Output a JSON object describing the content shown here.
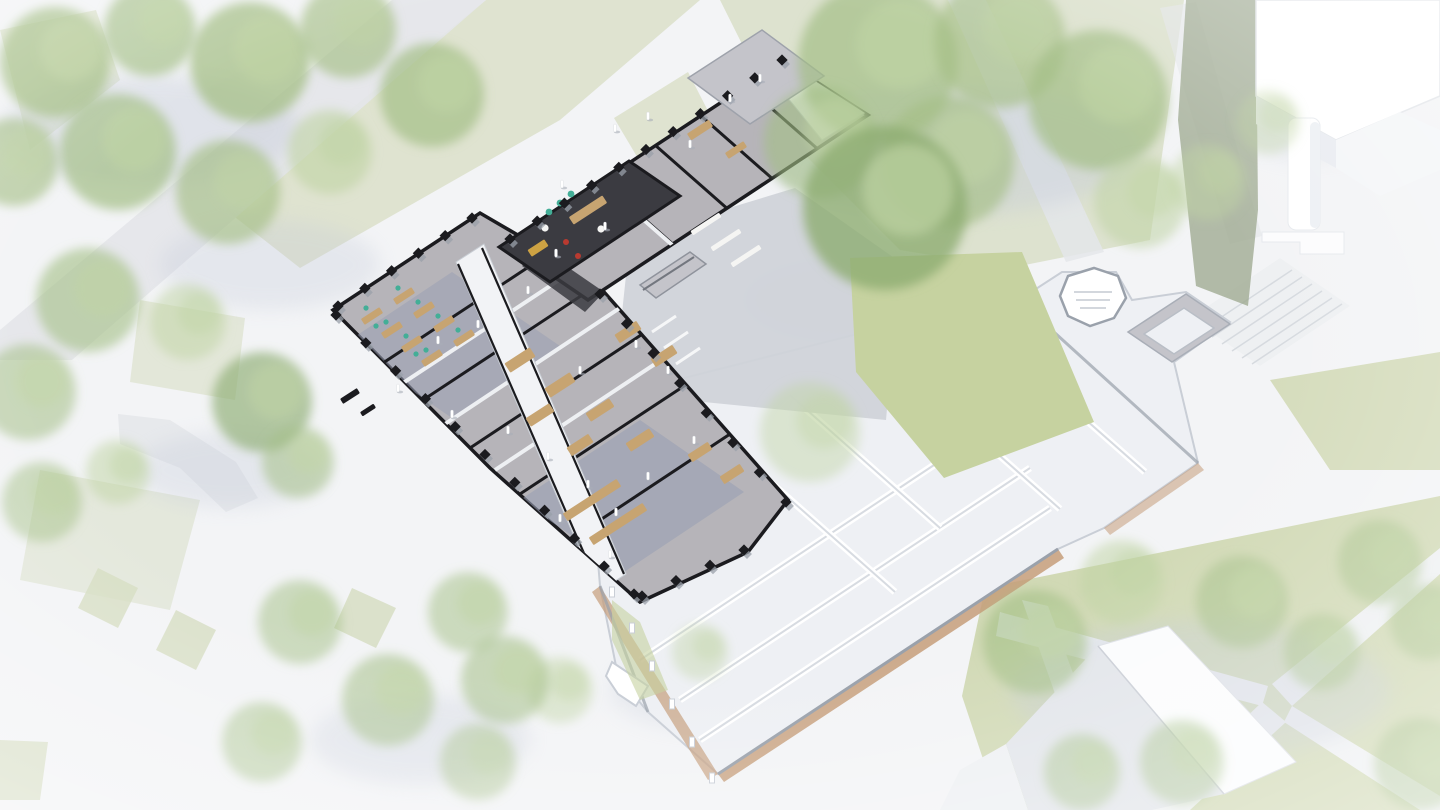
{
  "meta": {
    "description": "Aerial axonometric cutaway rendering of an L-shaped collegiate Gothic building. The north-west wing is shown in detail with black sectioned walls, pinnacled buttresses, grey floors and coloured furniture; the remainder of the quad is ghosted white. Washed-out park landscape with lawns, paths and trees surrounds it; white massing blocks sit top-right and bottom."
  },
  "colors": {
    "bg": "#f3f4f6",
    "path": "#e4e6ea",
    "pathBright": "#eef0f2",
    "grassPale": "#d5dcc1",
    "grassCourt": "#c6d2a0",
    "grassRight": "#cdd6ae",
    "treeGreen": "#a4bf86",
    "treeLight": "#c0d4a4",
    "treeDark": "#8dac72",
    "olive": "#9ba78c",
    "shadow": "#c5cbd9",
    "ghostWall": "#fcfdfe",
    "ghostStroke": "#c9ced6",
    "ghostFloor": "#eef0f4",
    "ghostCap": "#9aa1ab",
    "brick": "#c59d7a",
    "darkWall": "#1b1b1f",
    "floorGray": "#b6b4b9",
    "floorBlue": "#9aa0b4",
    "floorOffice": "#a9acb8",
    "roofGray": "#c4c4ca",
    "corridor": "#f2f3f6",
    "wood": "#c7a471",
    "teal": "#43ae97",
    "red": "#b93a30",
    "yellow": "#cda243",
    "darkFloor": "#3b3b41",
    "white": "#f5f5f3",
    "stepGray": "#d0d3d9",
    "people": "#ffffff"
  },
  "scene": {
    "trees": [
      [
        55,
        62,
        55,
        "g",
        0.75
      ],
      [
        150,
        30,
        46,
        "g",
        0.7
      ],
      [
        250,
        62,
        60,
        "g",
        0.75
      ],
      [
        348,
        30,
        48,
        "g",
        0.65
      ],
      [
        432,
        95,
        52,
        "g",
        0.7
      ],
      [
        118,
        152,
        58,
        "g",
        0.7
      ],
      [
        14,
        162,
        44,
        "g",
        0.65
      ],
      [
        228,
        192,
        52,
        "g",
        0.65
      ],
      [
        330,
        152,
        42,
        "l",
        0.6
      ],
      [
        88,
        300,
        52,
        "g",
        0.6
      ],
      [
        28,
        392,
        48,
        "g",
        0.55
      ],
      [
        188,
        322,
        38,
        "l",
        0.5
      ],
      [
        262,
        402,
        50,
        "d",
        0.65
      ],
      [
        298,
        462,
        36,
        "g",
        0.55
      ],
      [
        118,
        472,
        32,
        "l",
        0.5
      ],
      [
        42,
        502,
        40,
        "g",
        0.5
      ],
      [
        300,
        622,
        42,
        "g",
        0.5
      ],
      [
        388,
        700,
        46,
        "g",
        0.55
      ],
      [
        262,
        742,
        40,
        "g",
        0.5
      ],
      [
        478,
        762,
        38,
        "g",
        0.45
      ],
      [
        878,
        62,
        80,
        "g",
        0.7
      ],
      [
        1000,
        42,
        66,
        "g",
        0.65
      ],
      [
        1098,
        100,
        70,
        "g",
        0.7
      ],
      [
        948,
        162,
        66,
        "g",
        0.65
      ],
      [
        820,
        142,
        56,
        "g",
        0.6
      ],
      [
        1140,
        202,
        46,
        "l",
        0.55
      ],
      [
        885,
        208,
        82,
        "d",
        0.8
      ],
      [
        810,
        432,
        50,
        "l",
        0.45
      ],
      [
        1208,
        182,
        38,
        "l",
        0.45
      ],
      [
        1268,
        122,
        32,
        "l",
        0.4
      ],
      [
        1035,
        642,
        52,
        "g",
        0.6
      ],
      [
        1122,
        582,
        42,
        "l",
        0.5
      ],
      [
        1242,
        602,
        46,
        "g",
        0.55
      ],
      [
        1380,
        562,
        42,
        "g",
        0.5
      ],
      [
        1322,
        652,
        38,
        "g",
        0.5
      ],
      [
        1428,
        622,
        38,
        "g",
        0.5
      ],
      [
        1182,
        762,
        42,
        "g",
        0.5
      ],
      [
        1420,
        764,
        46,
        "g",
        0.55
      ],
      [
        1082,
        772,
        38,
        "g",
        0.5
      ],
      [
        560,
        690,
        33,
        "l",
        0.45
      ],
      [
        700,
        652,
        28,
        "l",
        0.4
      ],
      [
        468,
        612,
        40,
        "g",
        0.5
      ],
      [
        505,
        680,
        44,
        "g",
        0.55
      ]
    ],
    "tree_shadows": [
      [
        150,
        130,
        150,
        55,
        0.4
      ],
      [
        270,
        265,
        110,
        45,
        0.3
      ],
      [
        950,
        150,
        190,
        65,
        0.4
      ],
      [
        860,
        300,
        115,
        42,
        0.35
      ],
      [
        1200,
        690,
        190,
        70,
        0.35
      ],
      [
        230,
        470,
        95,
        38,
        0.3
      ],
      [
        420,
        740,
        110,
        45,
        0.3
      ],
      [
        1310,
        120,
        80,
        40,
        0.25
      ],
      [
        700,
        690,
        90,
        40,
        0.25
      ]
    ],
    "pinnacle_walls": [
      {
        "x1": 510,
        "y1": 239,
        "x2": 782,
        "y2": 60,
        "n": 11
      },
      {
        "x1": 338,
        "y1": 306,
        "x2": 472,
        "y2": 218,
        "n": 6
      },
      {
        "x1": 336,
        "y1": 315,
        "x2": 634,
        "y2": 594,
        "n": 11
      },
      {
        "x1": 600,
        "y1": 294,
        "x2": 786,
        "y2": 502,
        "n": 8
      },
      {
        "x1": 642,
        "y1": 596,
        "x2": 744,
        "y2": 550,
        "n": 4
      }
    ],
    "wall_posts": [
      [
        612,
        592
      ],
      [
        632,
        628
      ],
      [
        652,
        666
      ],
      [
        672,
        704
      ],
      [
        692,
        742
      ],
      [
        712,
        778
      ]
    ],
    "furniture": [
      [
        372,
        316,
        22,
        7,
        -33,
        "wood"
      ],
      [
        392,
        330,
        22,
        7,
        -33,
        "wood"
      ],
      [
        412,
        344,
        22,
        7,
        -33,
        "wood"
      ],
      [
        432,
        358,
        22,
        7,
        -33,
        "wood"
      ],
      [
        404,
        296,
        22,
        7,
        -33,
        "wood"
      ],
      [
        424,
        310,
        22,
        7,
        -33,
        "wood"
      ],
      [
        444,
        324,
        22,
        7,
        -33,
        "wood"
      ],
      [
        464,
        338,
        22,
        7,
        -33,
        "wood"
      ],
      [
        350,
        396,
        20,
        6,
        -33,
        "darkWall"
      ],
      [
        368,
        410,
        16,
        5,
        -33,
        "darkWall"
      ],
      [
        520,
        360,
        30,
        11,
        -33,
        "wood"
      ],
      [
        560,
        385,
        30,
        11,
        -33,
        "wood"
      ],
      [
        540,
        415,
        28,
        10,
        -33,
        "wood"
      ],
      [
        600,
        410,
        28,
        10,
        -33,
        "wood"
      ],
      [
        640,
        440,
        28,
        10,
        -33,
        "wood"
      ],
      [
        580,
        445,
        26,
        10,
        -33,
        "wood"
      ],
      [
        628,
        332,
        26,
        10,
        -33,
        "wood"
      ],
      [
        664,
        356,
        26,
        10,
        -33,
        "wood"
      ],
      [
        700,
        452,
        24,
        9,
        -33,
        "wood"
      ],
      [
        732,
        474,
        24,
        9,
        -33,
        "wood"
      ],
      [
        592,
        500,
        64,
        9,
        -33,
        "wood"
      ],
      [
        618,
        524,
        64,
        9,
        -33,
        "wood"
      ],
      [
        700,
        130,
        26,
        8,
        -33,
        "wood"
      ],
      [
        736,
        150,
        22,
        7,
        -33,
        "wood"
      ],
      [
        588,
        210,
        40,
        9,
        -33,
        "wood"
      ],
      [
        538,
        248,
        20,
        8,
        -33,
        "yellow"
      ],
      [
        706,
        224,
        34,
        5,
        -33,
        "white"
      ],
      [
        726,
        240,
        34,
        5,
        -33,
        "white"
      ],
      [
        746,
        256,
        34,
        5,
        -33,
        "white"
      ]
    ],
    "seat_dots": [
      [
        366,
        308,
        2.6,
        "teal"
      ],
      [
        386,
        322,
        2.6,
        "teal"
      ],
      [
        406,
        336,
        2.6,
        "teal"
      ],
      [
        426,
        350,
        2.6,
        "teal"
      ],
      [
        398,
        288,
        2.6,
        "teal"
      ],
      [
        418,
        302,
        2.6,
        "teal"
      ],
      [
        438,
        316,
        2.6,
        "teal"
      ],
      [
        458,
        330,
        2.6,
        "teal"
      ],
      [
        376,
        326,
        2.6,
        "teal"
      ],
      [
        416,
        354,
        2.6,
        "teal"
      ],
      [
        549,
        212,
        3.4,
        "teal"
      ],
      [
        560,
        203,
        3.4,
        "teal"
      ],
      [
        571,
        194,
        3.4,
        "teal"
      ],
      [
        566,
        242,
        3,
        "red"
      ],
      [
        578,
        256,
        3,
        "red"
      ],
      [
        545,
        228,
        3.6,
        "white"
      ],
      [
        601,
        229,
        3.6,
        "white"
      ]
    ],
    "people": [
      [
        615,
        130
      ],
      [
        648,
        118
      ],
      [
        690,
        146
      ],
      [
        730,
        100
      ],
      [
        760,
        80
      ],
      [
        562,
        186
      ],
      [
        605,
        228
      ],
      [
        556,
        255
      ],
      [
        528,
        292
      ],
      [
        478,
        326
      ],
      [
        438,
        342
      ],
      [
        398,
        390
      ],
      [
        452,
        416
      ],
      [
        508,
        432
      ],
      [
        548,
        458
      ],
      [
        588,
        486
      ],
      [
        616,
        514
      ],
      [
        648,
        478
      ],
      [
        694,
        442
      ],
      [
        668,
        372
      ],
      [
        636,
        346
      ],
      [
        580,
        372
      ],
      [
        610,
        556
      ],
      [
        560,
        520
      ]
    ]
  }
}
